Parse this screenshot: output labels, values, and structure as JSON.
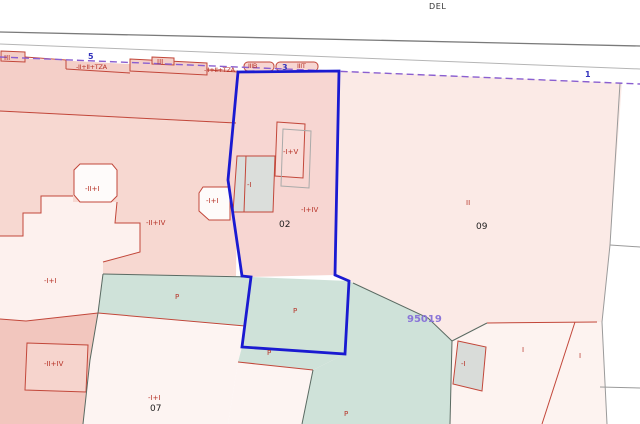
{
  "map": {
    "type": "cadastral-parcel-map",
    "street_name_fragment": "DEL",
    "selected_parcel": {
      "number": "02",
      "reference": "95019"
    },
    "colors": {
      "selection_blue": "#1a1ad1",
      "boundary_red": "#c2473a",
      "boundary_gray": "#5a6a62",
      "road_dark": "#7a7a7a",
      "road_light": "#b5b5b5",
      "street_dashed_purple": "#8a5fd0",
      "reference_purple": "#8a75d8",
      "parcel_pink": "#f7d6d2",
      "parcel_pink_light": "#fbeae6",
      "parcel_green": "#cfe2d9",
      "building_gray": "#dbdedb"
    }
  },
  "labels": [
    {
      "id": "street-name",
      "text": "DEL"
    },
    {
      "id": "facade-1",
      "text": "III"
    },
    {
      "id": "street-number-5",
      "text": "5"
    },
    {
      "id": "facade-2",
      "text": "-II+II+TZA"
    },
    {
      "id": "facade-3",
      "text": "III"
    },
    {
      "id": "facade-4",
      "text": "-II+II+TZA"
    },
    {
      "id": "facade-5",
      "text": "IIIB"
    },
    {
      "id": "street-number-3",
      "text": "3"
    },
    {
      "id": "facade-6",
      "text": "IIIT"
    },
    {
      "id": "street-number-1",
      "text": "1"
    },
    {
      "id": "constr-left-1",
      "text": "-II+I"
    },
    {
      "id": "constr-left-2",
      "text": "-I+I"
    },
    {
      "id": "constr-left-3",
      "text": "-II+IV"
    },
    {
      "id": "constr-02-a",
      "text": "-I"
    },
    {
      "id": "constr-02-b",
      "text": "-I+V"
    },
    {
      "id": "constr-02-c",
      "text": "-I+IV"
    },
    {
      "id": "parcel-number-02",
      "text": "02"
    },
    {
      "id": "constr-09",
      "text": "II"
    },
    {
      "id": "parcel-number-09",
      "text": "09"
    },
    {
      "id": "constr-left-4",
      "text": "-I+I"
    },
    {
      "id": "patio-p-1",
      "text": "P"
    },
    {
      "id": "patio-p-2",
      "text": "P"
    },
    {
      "id": "patio-p-3",
      "text": "P"
    },
    {
      "id": "parcel-reference",
      "text": "95019"
    },
    {
      "id": "constr-left-5",
      "text": "-II+IV"
    },
    {
      "id": "constr-07",
      "text": "-I+I"
    },
    {
      "id": "parcel-number-07",
      "text": "07"
    },
    {
      "id": "patio-p-4",
      "text": "P"
    },
    {
      "id": "constr-right-1",
      "text": "-I"
    },
    {
      "id": "constr-right-2",
      "text": "I"
    },
    {
      "id": "constr-right-3",
      "text": "I"
    }
  ]
}
